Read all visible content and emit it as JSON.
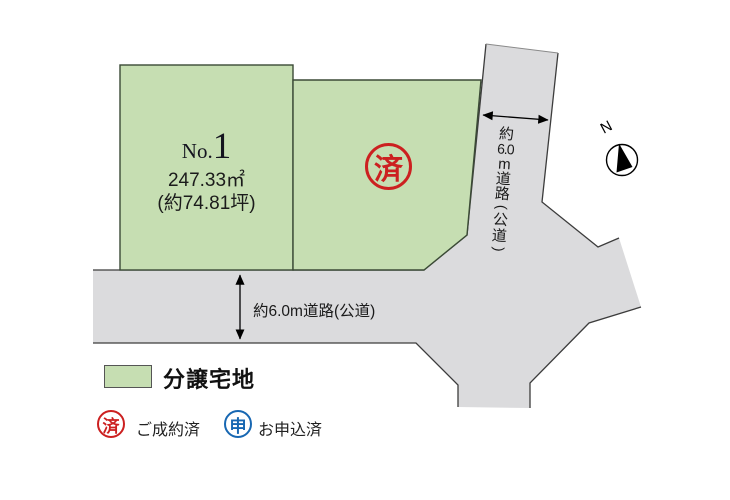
{
  "colors": {
    "plot_green": "#c6deb2",
    "road_gray": "#dbdbdd",
    "stamp_red": "#cc2020",
    "stamp_blue": "#1767b2",
    "outline": "#3c3c3c"
  },
  "plots": {
    "plot1": {
      "number_prefix": "No.",
      "number": "1",
      "area_m2": "247.33㎡",
      "area_tsubo": "(約74.81坪)"
    },
    "plot2": {
      "stamp": "済"
    }
  },
  "roads": {
    "vertical_label": "約6.0m道路(公道)",
    "vertical_label_parts": [
      "約",
      "6.0",
      "m",
      "道",
      "路",
      "(",
      "公",
      "道",
      ")"
    ],
    "horizontal_label": "約6.0m道路(公道)"
  },
  "compass": {
    "north": "N"
  },
  "legend": {
    "lot_label": "分譲宅地",
    "sold": {
      "stamp": "済",
      "label": "ご成約済"
    },
    "applied": {
      "stamp": "申",
      "label": "お申込済"
    }
  }
}
